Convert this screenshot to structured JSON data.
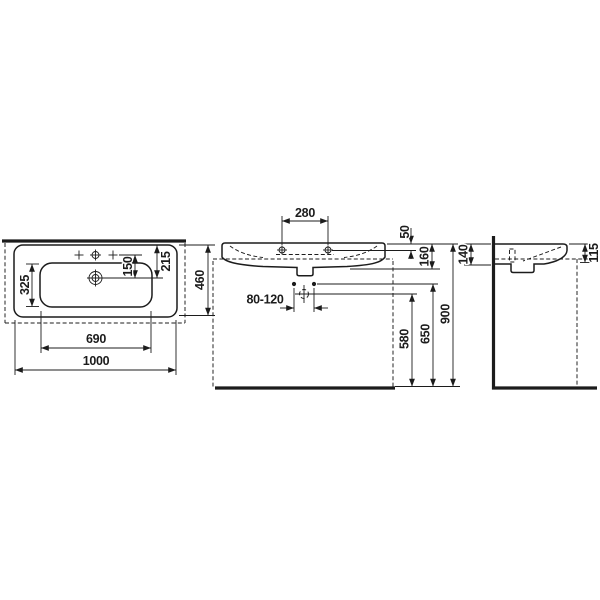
{
  "title": "washbasin-technical-drawing",
  "colors": {
    "line": "#1c1c1c",
    "background": "#ffffff"
  },
  "views": {
    "top": {
      "name": "plan-view",
      "dims": {
        "overall_width": "1000",
        "bowl_width": "690",
        "bowl_depth": "325",
        "tap_to_drain": "150",
        "rim_to_drain": "215",
        "overall_depth": "460"
      }
    },
    "front": {
      "name": "front-view",
      "dims": {
        "tap_hole_spacing": "280",
        "rim_to_fixing_holes": "50",
        "rim_to_outlet": "160",
        "valve_spacing_range": "80-120",
        "floor_to_trap": "580",
        "floor_to_valves": "650",
        "floor_to_rim": "900"
      }
    },
    "side": {
      "name": "side-view",
      "dims": {
        "height_at_wall": "140",
        "height_at_front": "115"
      }
    }
  }
}
